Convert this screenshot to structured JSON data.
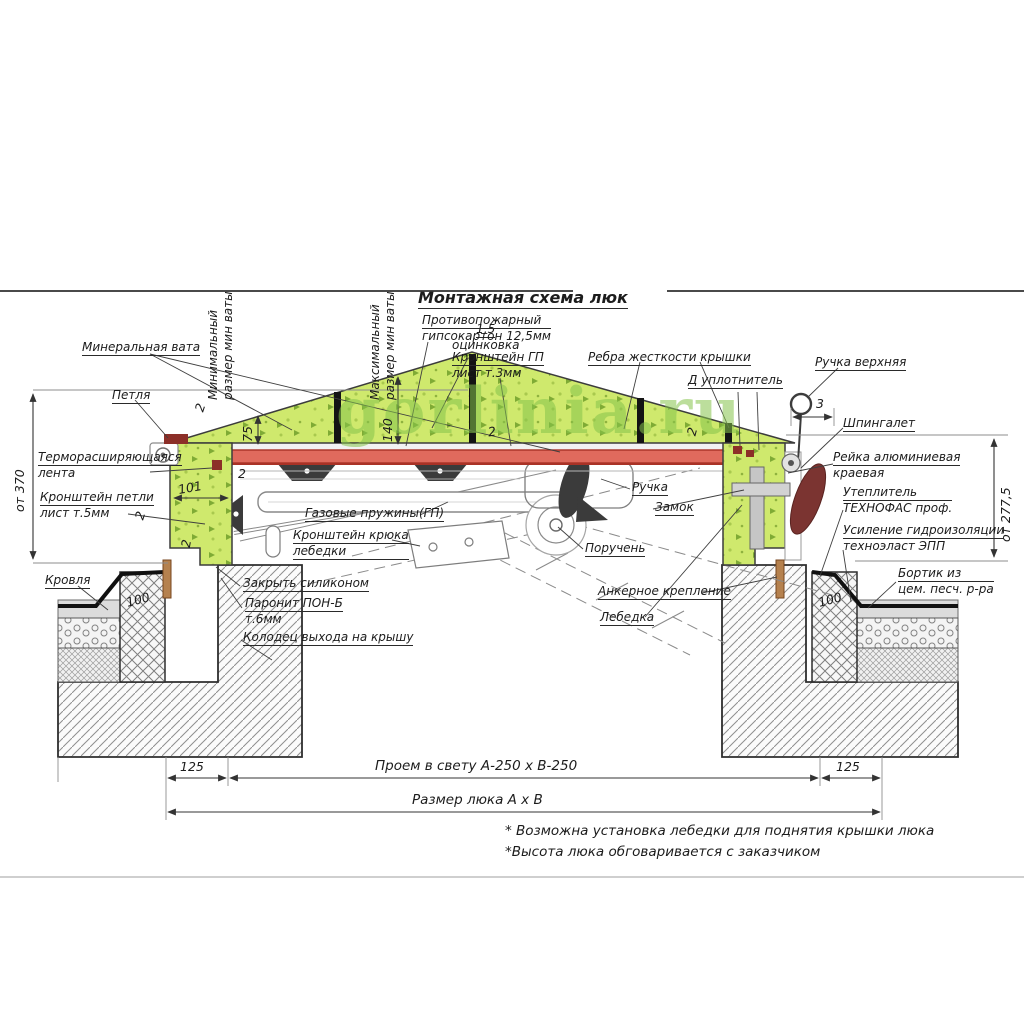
{
  "watermark": "gorlinia.ru",
  "title": "Монтажная схема люк",
  "labels": {
    "mineral_wool": "Минеральная вата",
    "hinge": "Петля",
    "thermo_tape_1": "Терморасширяющаяся",
    "thermo_tape_2": "лента",
    "hinge_bracket_1": "Кронштейн петли",
    "hinge_bracket_2": "лист т.5мм",
    "roof": "Кровля",
    "seal_silicone": "Закрыть силиконом",
    "paronite_1": "Паронит ПОН-Б",
    "paronite_2": "т.6мм",
    "shaft": "Колодец выхода на крышу",
    "galv_1": "1,5",
    "galv_2": "оцинковка",
    "min_wool_1": "Минимальный",
    "min_wool_2": "размер мин ваты",
    "max_wool_1": "Максимальный",
    "max_wool_2": "размер мин ваты",
    "fireproof_1": "Противопожарный",
    "fireproof_2": "гипсокартон 12,5мм",
    "gp_bracket_1": "Кронштейн ГП",
    "gp_bracket_2": "лист т.3мм",
    "ribs": "Ребра жесткости крышки",
    "seal_d": "Д уплотнитель",
    "top_handle": "Ручка верхняя",
    "latch": "Шпингалет",
    "alu_rail_1": "Рейка алюминиевая",
    "alu_rail_2": "краевая",
    "insulation_1": "Утеплитель",
    "insulation_2": "ТЕХНОФАС проф.",
    "waterproof_1": "Усиление гидроизоляции",
    "waterproof_2": "техноэласт ЭПП",
    "curb_1": "Бортик из",
    "curb_2": "цем. песч. р-ра",
    "handle": "Ручка",
    "lock": "Замок",
    "handrail": "Поручень",
    "anchor": "Анкерное крепление",
    "gas_springs": "Газовые пружины(ГП)",
    "winch_hook_1": "Кронштейн крюка",
    "winch_hook_2": "лебедки",
    "winch": "Лебедка"
  },
  "dimensions": {
    "h_left": "от 370",
    "h_right": "от 277,5",
    "wool_min": "75",
    "wool_max": "140",
    "wall_101": "101",
    "t2": "2",
    "t3": "3",
    "upstand_100": "100",
    "d125": "125",
    "opening": "Проем в свету А-250 х В-250",
    "hatch_size": "Размер люка А х В"
  },
  "notes": {
    "n1": "* Возможна установка лебедки для поднятия крышки люка",
    "n2": "*Высота люка обговаривается с заказчиком"
  },
  "colors": {
    "wool_green": "#cfe96d",
    "speckle_green": "#7fab35",
    "sheet_red": "#e06a5d",
    "dark_red": "#8c2f28",
    "line": "#3c3c3c"
  }
}
